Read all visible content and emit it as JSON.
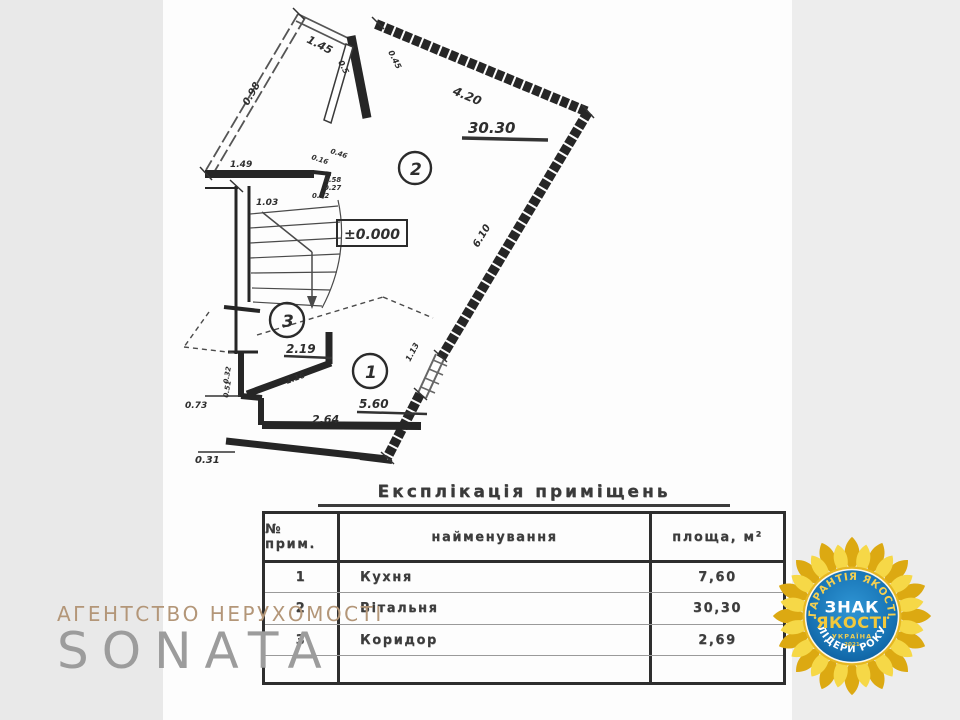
{
  "plan": {
    "elevation": "±0.000",
    "room1": "1",
    "room2": "2",
    "room3": "3",
    "dims": {
      "d145": "1.45",
      "d05": "0.5",
      "d045": "0.45",
      "d098": "0.98",
      "d420": "4.20",
      "a3030": "30.30",
      "d610": "6.10",
      "d149": "1.49",
      "d103": "1.03",
      "d016": "0.16",
      "d046": "0.46",
      "d058": "0.58",
      "d027": "0.27",
      "d012": "0.12",
      "d219": "2.19",
      "d116": "1.16",
      "a560": "5.60",
      "d264": "2.64",
      "d073": "0.73",
      "d031": "0.31",
      "d032": "0.32",
      "d051": "0.51",
      "d113": "1.13"
    }
  },
  "table": {
    "title": "Експлікація приміщень",
    "headers": {
      "num": "№ прим.",
      "name": "найменування",
      "area": "площа, м²"
    },
    "rows": [
      {
        "num": "1",
        "name": "Кухня",
        "area": "7,60"
      },
      {
        "num": "2",
        "name": "Вітальня",
        "area": "30,30"
      },
      {
        "num": "3",
        "name": "Коридор",
        "area": "2,69"
      },
      {
        "num": "",
        "name": "",
        "area": ""
      }
    ]
  },
  "logo": {
    "tagline": "АГЕНТСТВО НЕРУХОМОСТІ",
    "name": "SONATA"
  },
  "badge": {
    "arc_top": "ГАРАНТІЯ ЯКОСТІ",
    "center_line1": "ЗНАК",
    "center_line2": "ЯКОСТІ",
    "country": "УКРАЇНА",
    "year": "2021",
    "arc_bottom": "ЛІДЕРИ РОКУ",
    "dot": "•"
  },
  "colors": {
    "ink": "#2e2e2e",
    "badge_blue": "#1878be",
    "badge_gold": "#e6b722",
    "logo_tan": "#b39678",
    "logo_gray": "#9c9c9c"
  }
}
